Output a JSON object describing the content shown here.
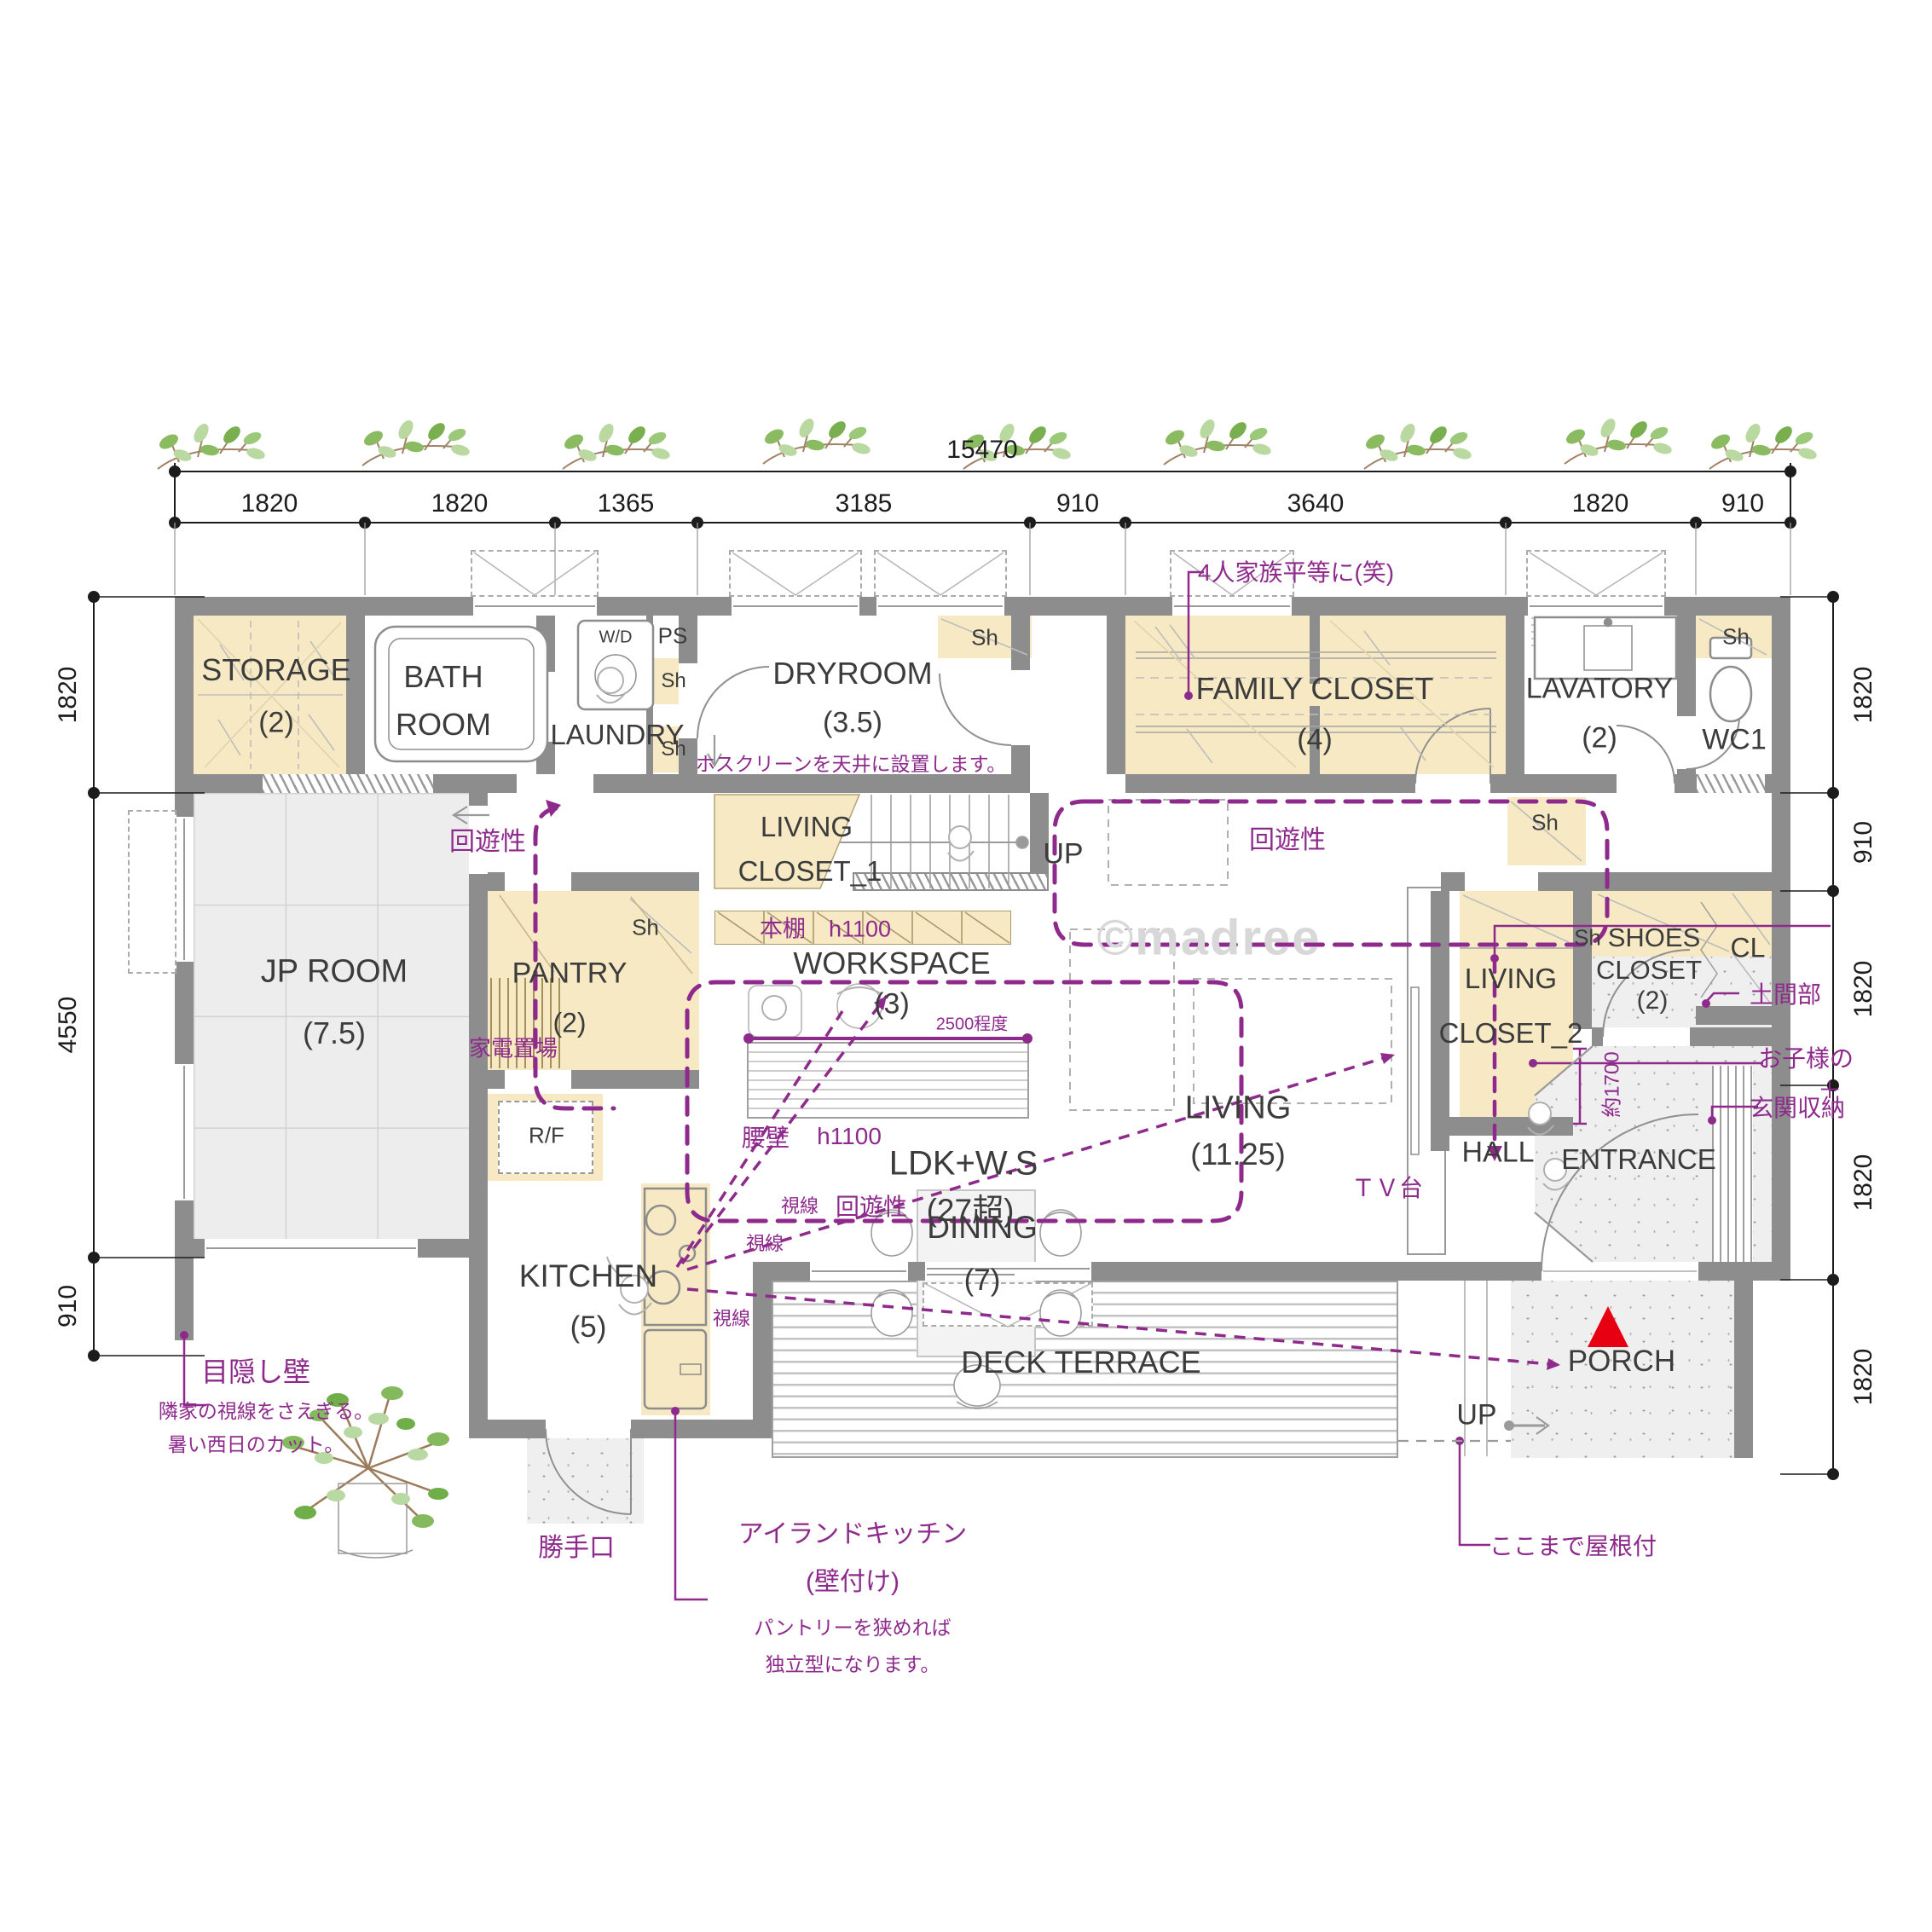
{
  "watermark": "©madree",
  "dims": {
    "total": "15470",
    "top": [
      "1820",
      "1820",
      "1365",
      "3185",
      "910",
      "3640",
      "1820",
      "910"
    ],
    "left": [
      "1820",
      "4550",
      "910"
    ],
    "right": [
      "1820",
      "910",
      "1820",
      "1820",
      "1820"
    ]
  },
  "rooms": {
    "storage": "STORAGE",
    "storage_s": "(2)",
    "bath1": "BATH",
    "bath2": "ROOM",
    "laundry": "LAUNDRY",
    "dryroom": "DRYROOM",
    "dryroom_s": "(3.5)",
    "family": "FAMILY CLOSET",
    "family_s": "(4)",
    "lavatory": "LAVATORY",
    "lavatory_s": "(2)",
    "wc": "WC1",
    "cl": "CL",
    "jp": "JP ROOM",
    "jp_s": "(7.5)",
    "pantry": "PANTRY",
    "pantry_s": "(2)",
    "workspace": "WORKSPACE",
    "workspace_s": "(3)",
    "living": "LIVING",
    "living_s": "(11.25)",
    "lc1a": "LIVING",
    "lc1b": "CLOSET_1",
    "lc2a": "LIVING",
    "lc2b": "CLOSET_2",
    "shoes1": "SHOES",
    "shoes2": "CLOSET",
    "shoes3": "(2)",
    "hall": "HALL",
    "entrance": "ENTRANCE",
    "dining": "DINING",
    "dining_s": "(7)",
    "kitchen": "KITCHEN",
    "kitchen_s": "(5)",
    "ldk": "LDK+W.S",
    "ldk_s": "(27超)",
    "deck": "DECK TERRACE",
    "porch": "PORCH"
  },
  "small": {
    "sh": "Sh",
    "ps": "PS",
    "wd": "W/D",
    "rf": "R/F",
    "up": "UP"
  },
  "purple": {
    "family_note": "4人家族平等に(笑)",
    "dry_note": "ホスクリーンを天井に設置します。",
    "kaiyu": "回遊性",
    "shisen": "視線",
    "bookshelf": "本棚　h1100",
    "w2500": "2500程度",
    "kaden": "家電置場",
    "koshikabe": "腰壁",
    "h1100": "h1100",
    "tv": "ＴＶ台",
    "doma": "土間部",
    "kids": "お子様の",
    "kids2": "＋",
    "genkan": "玄関収納",
    "yaku": "約1700",
    "mekakushi": "目隠し壁",
    "mekakushi1": "隣家の視線をさえぎる。",
    "mekakushi2": "暑い西日のカット。",
    "katte": "勝手口",
    "island1": "アイランドキッチン",
    "island2": "(壁付け)",
    "island3": "パントリーを狭めれば",
    "island4": "独立型になります。",
    "roof": "ここまで屋根付"
  }
}
